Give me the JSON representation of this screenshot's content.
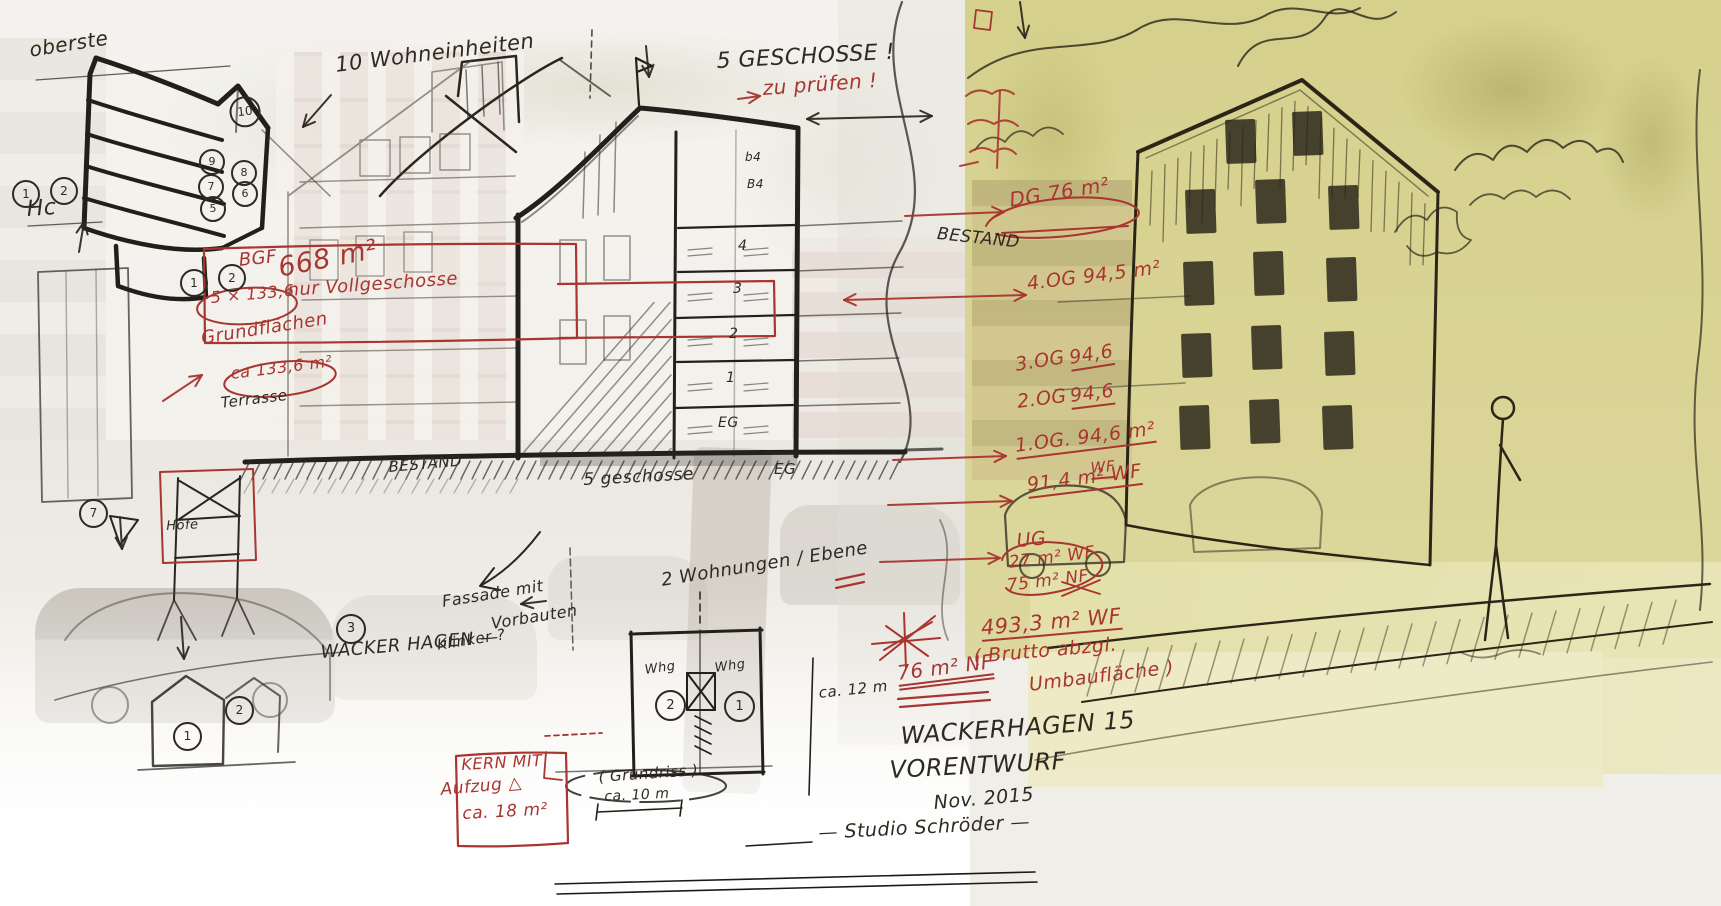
{
  "project": {
    "name": "WACKERHAGEN 15",
    "phase": "VORENTWURF",
    "date": "Nov. 2015",
    "credit": "— Studio Schröder —"
  },
  "palette": {
    "ink": "#2e2a22",
    "red": "#a93530",
    "paper": "#edeae3",
    "photo_yellow": "#d7d291",
    "photo_gray": "#e7e4dd"
  },
  "floor_schedule": {
    "rows": [
      {
        "floor": "DG",
        "area": "76 m²"
      },
      {
        "floor": "4.OG",
        "area": "94,5 m²"
      },
      {
        "floor": "3.OG",
        "area": "94,6"
      },
      {
        "floor": "2.OG",
        "area": "94,6"
      },
      {
        "floor": "1.OG",
        "area": "94,6 m² WF"
      },
      {
        "floor": "EG",
        "area": "91,4 m² WF"
      },
      {
        "floor": "UG",
        "area": "27 m² WF / 75 m² NF"
      }
    ],
    "total_wf": "493,3 m² WF",
    "total_note": "( Brutto abzgl. Umbaufläche )",
    "total_nf": "76 m² NF"
  },
  "texts": [
    {
      "n": "label-oberste",
      "t": "oberste",
      "x": 28,
      "y": 40,
      "s": 20,
      "c": "ink",
      "r": -9
    },
    {
      "n": "label-hc",
      "t": "Hc",
      "x": 26,
      "y": 198,
      "s": 22,
      "c": "ink",
      "r": -4
    },
    {
      "n": "note-10-wohneinheiten",
      "t": "10 Wohneinheiten",
      "x": 334,
      "y": 54,
      "s": 21,
      "c": "ink",
      "r": -7
    },
    {
      "n": "note-5-geschosse",
      "t": "5 GESCHOSSE !",
      "x": 716,
      "y": 50,
      "s": 22,
      "c": "ink",
      "r": -3
    },
    {
      "n": "label-bestand-baum",
      "t": "BESTAND",
      "x": 938,
      "y": 226,
      "s": 17,
      "c": "ink",
      "r": 6
    },
    {
      "n": "label-bestand-links",
      "t": "BESTAND",
      "x": 388,
      "y": 460,
      "s": 15,
      "c": "ink",
      "r": -5
    },
    {
      "n": "label-terrasse",
      "t": "Terrasse",
      "x": 220,
      "y": 396,
      "s": 15,
      "c": "ink",
      "r": -7
    },
    {
      "n": "label-5-geschosse-sockel",
      "t": "5 geschosse",
      "x": 583,
      "y": 472,
      "s": 17,
      "c": "ink",
      "r": -3
    },
    {
      "n": "note-fassade-1",
      "t": "Fassade mit",
      "x": 441,
      "y": 594,
      "s": 16,
      "c": "ink",
      "r": -9
    },
    {
      "n": "note-fassade-2",
      "t": "Vorbauten",
      "x": 490,
      "y": 616,
      "s": 16,
      "c": "ink",
      "r": -9
    },
    {
      "n": "note-fassade-3",
      "t": "Klinker ?",
      "x": 436,
      "y": 638,
      "s": 15,
      "c": "ink",
      "r": -9
    },
    {
      "n": "note-2-wohnungen",
      "t": "2 Wohnungen / Ebene",
      "x": 660,
      "y": 572,
      "s": 18,
      "c": "ink",
      "r": -9
    },
    {
      "n": "dim-ca-12m",
      "t": "ca. 12 m",
      "x": 818,
      "y": 686,
      "s": 15,
      "c": "ink",
      "r": -6
    },
    {
      "n": "label-wacker-hagen",
      "t": "WACKER HAGEN —",
      "x": 320,
      "y": 644,
      "s": 18,
      "c": "ink",
      "r": -5
    },
    {
      "n": "label-whg-2",
      "t": "Whg",
      "x": 644,
      "y": 664,
      "s": 13,
      "c": "ink",
      "r": -8
    },
    {
      "n": "label-whg-1",
      "t": "Whg",
      "x": 714,
      "y": 662,
      "s": 13,
      "c": "ink",
      "r": -8
    },
    {
      "n": "label-grundriss",
      "t": "( Grundriss )",
      "x": 598,
      "y": 770,
      "s": 15,
      "c": "ink",
      "r": -4
    },
    {
      "n": "dim-ca-10m",
      "t": "ca. 10 m",
      "x": 604,
      "y": 790,
      "s": 14,
      "c": "ink",
      "r": -3
    },
    {
      "n": "title-project",
      "t": "WACKERHAGEN 15",
      "x": 900,
      "y": 724,
      "s": 24,
      "c": "ink",
      "r": -4
    },
    {
      "n": "title-phase",
      "t": "VORENTWURF",
      "x": 889,
      "y": 758,
      "s": 24,
      "c": "ink",
      "r": -3
    },
    {
      "n": "title-date",
      "t": "Nov. 2015",
      "x": 933,
      "y": 794,
      "s": 19,
      "c": "ink",
      "r": -5
    },
    {
      "n": "title-credit",
      "t": "— Studio Schröder —",
      "x": 818,
      "y": 824,
      "s": 19,
      "c": "ink",
      "r": -3
    },
    {
      "n": "label-hoefe",
      "t": "Höfe",
      "x": 166,
      "y": 520,
      "s": 13,
      "c": "ink",
      "r": -3
    },
    {
      "n": "floor-4",
      "t": "4",
      "x": 738,
      "y": 239,
      "s": 14,
      "c": "ink"
    },
    {
      "n": "floor-3",
      "t": "3",
      "x": 733,
      "y": 282,
      "s": 14,
      "c": "ink"
    },
    {
      "n": "floor-2",
      "t": "2",
      "x": 729,
      "y": 327,
      "s": 14,
      "c": "ink"
    },
    {
      "n": "floor-1",
      "t": "1",
      "x": 726,
      "y": 371,
      "s": 14,
      "c": "ink"
    },
    {
      "n": "floor-eg",
      "t": "EG",
      "x": 718,
      "y": 416,
      "s": 14,
      "c": "ink"
    },
    {
      "n": "label-eg-sockel",
      "t": "EG",
      "x": 774,
      "y": 462,
      "s": 15,
      "c": "ink"
    },
    {
      "n": "label-b4-oben",
      "t": "b4",
      "x": 745,
      "y": 151,
      "s": 12,
      "c": "ink"
    },
    {
      "n": "label-b4-unten",
      "t": "B4",
      "x": 747,
      "y": 178,
      "s": 12,
      "c": "ink"
    },
    {
      "n": "circle-10",
      "t": "10",
      "x": 228,
      "y": 98,
      "s": 12,
      "c": "ink",
      "circle": true,
      "d": 27,
      "r": -6
    },
    {
      "n": "circle-9",
      "t": "9",
      "x": 199,
      "y": 149,
      "s": 11,
      "c": "ink",
      "circle": true,
      "d": 22
    },
    {
      "n": "circle-8",
      "t": "8",
      "x": 231,
      "y": 160,
      "s": 11,
      "c": "ink",
      "circle": true,
      "d": 22
    },
    {
      "n": "circle-7",
      "t": "7",
      "x": 198,
      "y": 174,
      "s": 11,
      "c": "ink",
      "circle": true,
      "d": 22
    },
    {
      "n": "circle-6",
      "t": "6",
      "x": 232,
      "y": 181,
      "s": 11,
      "c": "ink",
      "circle": true,
      "d": 22
    },
    {
      "n": "circle-5",
      "t": "5",
      "x": 200,
      "y": 196,
      "s": 11,
      "c": "ink",
      "circle": true,
      "d": 22
    },
    {
      "n": "circle-1-links",
      "t": "1",
      "x": 12,
      "y": 180,
      "s": 12,
      "c": "ink",
      "circle": true,
      "d": 24
    },
    {
      "n": "circle-2-links",
      "t": "2",
      "x": 50,
      "y": 177,
      "s": 12,
      "c": "ink",
      "circle": true,
      "d": 24
    },
    {
      "n": "circle-1-bgf",
      "t": "1",
      "x": 180,
      "y": 269,
      "s": 12,
      "c": "ink",
      "circle": true,
      "d": 24
    },
    {
      "n": "circle-2-bgf",
      "t": "2",
      "x": 218,
      "y": 264,
      "s": 12,
      "c": "ink",
      "circle": true,
      "d": 24
    },
    {
      "n": "circle-7-unten",
      "t": "7",
      "x": 79,
      "y": 499,
      "s": 12,
      "c": "ink",
      "circle": true,
      "d": 25
    },
    {
      "n": "circle-3",
      "t": "3",
      "x": 336,
      "y": 614,
      "s": 13,
      "c": "ink",
      "circle": true,
      "d": 26
    },
    {
      "n": "circle-1-haus",
      "t": "1",
      "x": 173,
      "y": 722,
      "s": 12,
      "c": "ink",
      "circle": true,
      "d": 25
    },
    {
      "n": "circle-2-haus",
      "t": "2",
      "x": 225,
      "y": 696,
      "s": 12,
      "c": "ink",
      "circle": true,
      "d": 25
    },
    {
      "n": "circle-2-plan",
      "t": "2",
      "x": 655,
      "y": 690,
      "s": 13,
      "c": "ink",
      "circle": true,
      "d": 27
    },
    {
      "n": "circle-1-plan",
      "t": "1",
      "x": 724,
      "y": 691,
      "s": 13,
      "c": "ink",
      "circle": true,
      "d": 27
    },
    {
      "n": "note-zu-pruefen",
      "t": "zu prüfen !",
      "x": 762,
      "y": 78,
      "s": 20,
      "c": "red",
      "r": -4
    },
    {
      "n": "label-bgf",
      "t": "BGF",
      "x": 238,
      "y": 252,
      "s": 18,
      "c": "red",
      "r": -6
    },
    {
      "n": "value-bgf",
      "t": "668 m²",
      "x": 276,
      "y": 255,
      "s": 27,
      "c": "red",
      "r": -11
    },
    {
      "n": "calc-bgf",
      "t": "5 × 133,6",
      "x": 210,
      "y": 290,
      "s": 16,
      "c": "red",
      "r": -5
    },
    {
      "n": "note-vollgeschosse",
      "t": "nur Vollgeschosse",
      "x": 287,
      "y": 282,
      "s": 18,
      "c": "red",
      "r": -4
    },
    {
      "n": "label-grundflaeche",
      "t": "Grundflächen",
      "x": 200,
      "y": 330,
      "s": 18,
      "c": "red",
      "r": -9
    },
    {
      "n": "value-grundflaeche",
      "t": "ca 133,6 m²",
      "x": 230,
      "y": 366,
      "s": 16,
      "c": "red",
      "r": -7
    },
    {
      "n": "row-dg",
      "t": "DG  76 m²",
      "x": 1008,
      "y": 190,
      "s": 20,
      "c": "red",
      "r": -9
    },
    {
      "n": "row-4og",
      "t": "4.OG  94,5 m²",
      "x": 1026,
      "y": 275,
      "s": 19,
      "c": "red",
      "r": -7
    },
    {
      "n": "row-3og",
      "t": "3.OG",
      "x": 1014,
      "y": 356,
      "s": 19,
      "c": "red",
      "r": -9
    },
    {
      "n": "row-3og-wert",
      "t": "94,6",
      "x": 1068,
      "y": 349,
      "s": 19,
      "c": "red",
      "r": -9,
      "u": 1
    },
    {
      "n": "row-2og",
      "t": "2.OG",
      "x": 1016,
      "y": 393,
      "s": 19,
      "c": "red",
      "r": -7
    },
    {
      "n": "row-2og-wert",
      "t": "94,6",
      "x": 1069,
      "y": 387,
      "s": 19,
      "c": "red",
      "r": -7,
      "u": 1
    },
    {
      "n": "row-1og",
      "t": "1.OG.  94,6 m²",
      "x": 1014,
      "y": 437,
      "s": 19,
      "c": "red",
      "r": -7,
      "u": 1
    },
    {
      "n": "row-1og-wf",
      "t": "WF",
      "x": 1090,
      "y": 461,
      "s": 15,
      "c": "red",
      "r": -5,
      "u": 1
    },
    {
      "n": "row-eg-wert",
      "t": "91,4 m² WF",
      "x": 1026,
      "y": 476,
      "s": 19,
      "c": "red",
      "r": -7,
      "u": 1
    },
    {
      "n": "row-ug",
      "t": "UG",
      "x": 1016,
      "y": 532,
      "s": 19,
      "c": "red",
      "r": -5
    },
    {
      "n": "row-ug-wf",
      "t": "27 m² WF",
      "x": 1008,
      "y": 555,
      "s": 17,
      "c": "red",
      "r": -7
    },
    {
      "n": "row-ug-nf",
      "t": "75 m² NF",
      "x": 1006,
      "y": 578,
      "s": 17,
      "c": "red",
      "r": -7
    },
    {
      "n": "total-wf",
      "t": "493,3 m² WF",
      "x": 980,
      "y": 617,
      "s": 21,
      "c": "red",
      "r": -5,
      "u": 1
    },
    {
      "n": "note-brutto-1",
      "t": "( Brutto abzgl.",
      "x": 973,
      "y": 648,
      "s": 19,
      "c": "red",
      "r": -5
    },
    {
      "n": "note-brutto-2",
      "t": "Umbaufläche )",
      "x": 1028,
      "y": 676,
      "s": 19,
      "c": "red",
      "r": -7
    },
    {
      "n": "total-nf",
      "t": "76 m² NF",
      "x": 896,
      "y": 663,
      "s": 20,
      "c": "red",
      "r": -7,
      "u": 2
    },
    {
      "n": "kern-zeile-1",
      "t": "KERN MIT",
      "x": 461,
      "y": 757,
      "s": 16,
      "c": "red",
      "r": -3
    },
    {
      "n": "kern-zeile-2",
      "t": "Aufzug △",
      "x": 440,
      "y": 782,
      "s": 17,
      "c": "red",
      "r": -5
    },
    {
      "n": "kern-zeile-3",
      "t": "ca. 18 m²",
      "x": 462,
      "y": 806,
      "s": 17,
      "c": "red",
      "r": -3
    }
  ]
}
